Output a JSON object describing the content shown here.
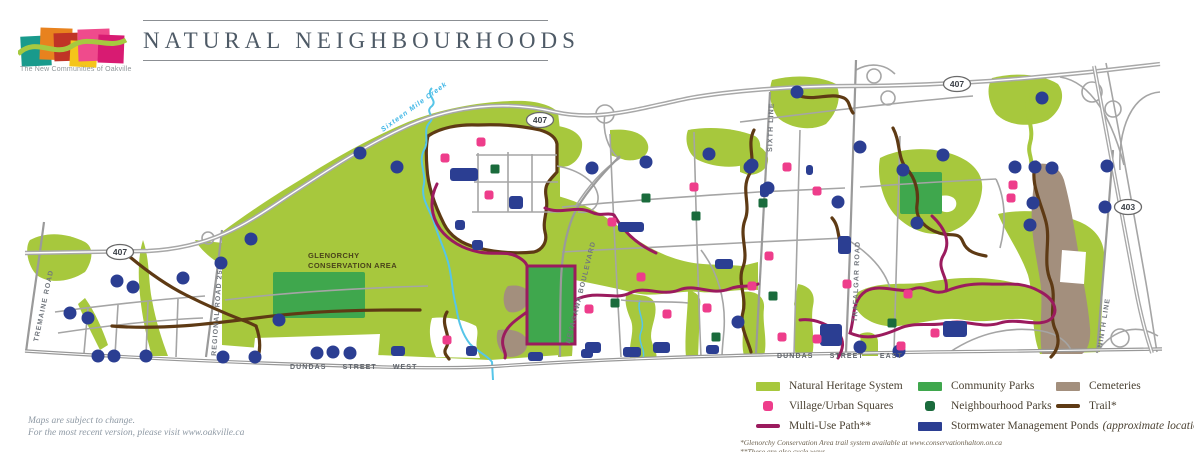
{
  "logo": {
    "tagline": "The New Communities of Oakville"
  },
  "header": {
    "title": "NATURAL NEIGHBOURHOODS"
  },
  "notes": {
    "line1": "Maps are subject to change.",
    "line2": "For the most recent version, please visit www.oakville.ca"
  },
  "map": {
    "colors": {
      "nhs": "#a7c83d",
      "community": "#3fa74d",
      "neighbourhood": "#1a6b3c",
      "village": "#ee3d8b",
      "multiuse": "#9b1b5e",
      "trail": "#5e3a14",
      "pond": "#2b3e92",
      "cemetery": "#a38f7d",
      "creek": "#56c5e8",
      "road": "#9e9e9e"
    },
    "labels": {
      "glenorchy_line1": "GLENORCHY",
      "glenorchy_line2": "CONSERVATION AREA",
      "creek": "Sixteen Mile Creek",
      "roads": {
        "tremaine": "TREMAINE ROAD",
        "regional": "REGIONAL ROAD 25",
        "neyagawa": "NEYAGAWA BOULEVARD",
        "sixth": "SIXTH LINE",
        "trafalgar": "TRAFALGAR ROAD",
        "ninth": "NINTH LINE",
        "dundas_west": "DUNDAS STREET WEST",
        "dundas_east": "DUNDAS STREET EAST"
      },
      "shields": [
        {
          "label": "407",
          "x": 120,
          "y": 252
        },
        {
          "label": "407",
          "x": 540,
          "y": 120
        },
        {
          "label": "407",
          "x": 957,
          "y": 84
        },
        {
          "label": "403",
          "x": 1128,
          "y": 207
        }
      ]
    },
    "features": {
      "community_parks": [
        [
          273,
          272,
          92,
          46
        ],
        [
          527,
          266,
          48,
          78
        ],
        [
          900,
          172,
          42,
          42
        ]
      ],
      "ponds_round": [
        [
          117,
          281
        ],
        [
          133,
          287
        ],
        [
          183,
          278
        ],
        [
          221,
          263
        ],
        [
          251,
          239
        ],
        [
          70,
          313
        ],
        [
          88,
          318
        ],
        [
          98,
          356
        ],
        [
          114,
          356
        ],
        [
          146,
          356
        ],
        [
          223,
          357
        ],
        [
          255,
          357
        ],
        [
          279,
          320
        ],
        [
          360,
          153
        ],
        [
          397,
          167
        ],
        [
          317,
          353
        ],
        [
          333,
          352
        ],
        [
          350,
          353
        ],
        [
          592,
          168
        ],
        [
          646,
          162
        ],
        [
          709,
          154
        ],
        [
          752,
          165
        ],
        [
          797,
          92
        ],
        [
          860,
          147
        ],
        [
          750,
          167
        ],
        [
          943,
          155
        ],
        [
          768,
          188
        ],
        [
          838,
          202
        ],
        [
          917,
          223
        ],
        [
          903,
          170
        ],
        [
          1015,
          167
        ],
        [
          1035,
          167
        ],
        [
          1052,
          168
        ],
        [
          1107,
          166
        ],
        [
          1033,
          203
        ],
        [
          1105,
          207
        ],
        [
          1030,
          225
        ],
        [
          1042,
          98
        ],
        [
          860,
          347
        ],
        [
          738,
          322
        ],
        [
          899,
          351
        ]
      ],
      "ponds_rect": [
        [
          450,
          168,
          28,
          13
        ],
        [
          509,
          196,
          14,
          13
        ],
        [
          455,
          220,
          10,
          10
        ],
        [
          472,
          240,
          11,
          10
        ],
        [
          466,
          346,
          11,
          10
        ],
        [
          528,
          352,
          15,
          9
        ],
        [
          581,
          349,
          12,
          9
        ],
        [
          391,
          346,
          14,
          10
        ],
        [
          618,
          222,
          26,
          10
        ],
        [
          715,
          259,
          18,
          10
        ],
        [
          585,
          342,
          16,
          11
        ],
        [
          623,
          347,
          18,
          10
        ],
        [
          653,
          342,
          17,
          11
        ],
        [
          706,
          345,
          13,
          9
        ],
        [
          760,
          184,
          9,
          13
        ],
        [
          806,
          165,
          7,
          10
        ],
        [
          838,
          236,
          13,
          18
        ],
        [
          820,
          324,
          22,
          22
        ],
        [
          943,
          321,
          24,
          16
        ]
      ],
      "village_squares": [
        [
          445,
          158
        ],
        [
          481,
          142
        ],
        [
          489,
          195
        ],
        [
          612,
          222
        ],
        [
          641,
          277
        ],
        [
          589,
          309
        ],
        [
          667,
          314
        ],
        [
          694,
          187
        ],
        [
          769,
          256
        ],
        [
          707,
          308
        ],
        [
          447,
          340
        ],
        [
          752,
          286
        ],
        [
          782,
          337
        ],
        [
          817,
          339
        ],
        [
          847,
          284
        ],
        [
          908,
          294
        ],
        [
          935,
          333
        ],
        [
          901,
          346
        ],
        [
          1013,
          185
        ],
        [
          1011,
          198
        ],
        [
          787,
          167
        ],
        [
          817,
          191
        ]
      ],
      "neighbourhood_parks": [
        [
          495,
          169
        ],
        [
          646,
          198
        ],
        [
          696,
          216
        ],
        [
          615,
          303
        ],
        [
          716,
          337
        ],
        [
          773,
          296
        ],
        [
          892,
          323
        ],
        [
          763,
          203
        ]
      ]
    }
  },
  "legend": {
    "items": [
      {
        "label": "Natural Heritage System",
        "swatch": "area",
        "color": "#a7c83d"
      },
      {
        "label": "Village/Urban Squares",
        "swatch": "square",
        "color": "#ee3d8b"
      },
      {
        "label": "Multi-Use Path**",
        "swatch": "line",
        "color": "#9b1b5e"
      },
      {
        "label": "Community Parks",
        "swatch": "area",
        "color": "#3fa74d"
      },
      {
        "label": "Neighbourhood Parks",
        "swatch": "square",
        "color": "#1a6b3c"
      },
      {
        "label": "Stormwater Management Ponds",
        "swatch": "area",
        "color": "#2b3e92"
      },
      {
        "label": "Cemeteries",
        "swatch": "area",
        "color": "#a38f7d"
      },
      {
        "label": "Trail*",
        "swatch": "line",
        "color": "#5e3a14"
      }
    ],
    "approx_suffix": "(approximate locations)",
    "footnote1": "*Glenorchy Conservation Area trail system available at www.conservationhalton.on.ca",
    "footnote2": "**These are also cycle ways"
  }
}
